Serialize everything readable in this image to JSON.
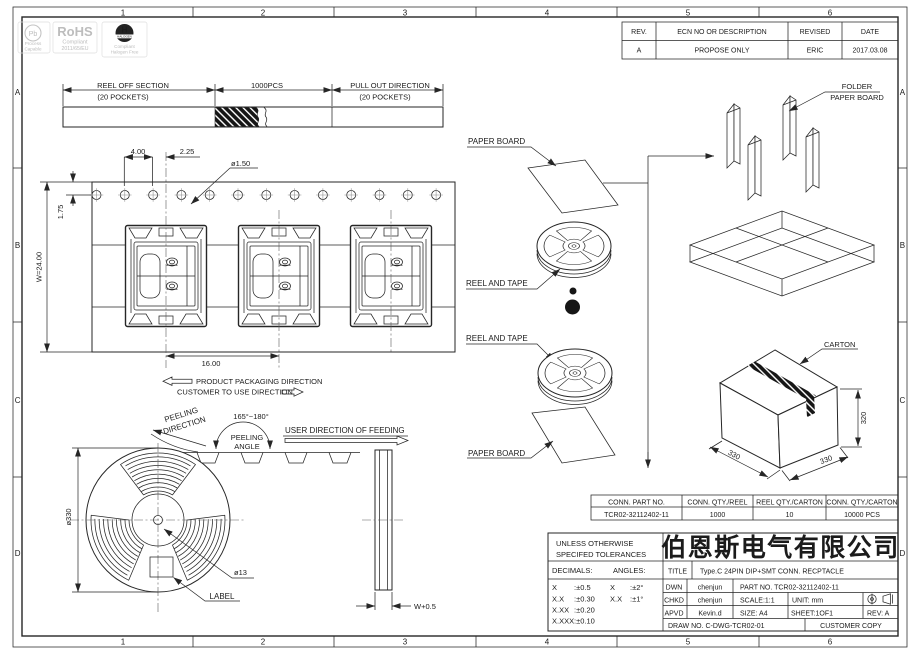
{
  "grid": {
    "cols": [
      "1",
      "2",
      "3",
      "4",
      "5",
      "6"
    ],
    "rows": [
      "A",
      "B",
      "C",
      "D"
    ]
  },
  "logos": {
    "pb": {
      "symbol": "Pb",
      "caption1": "Process",
      "caption2": "Capable"
    },
    "rohs": {
      "title": "RoHS",
      "caption1": "Compliant",
      "caption2": "2011/65/EU"
    },
    "halogen": {
      "symbol": "H",
      "band": "HALOGEN",
      "caption1": "Compliant",
      "caption2": "Halogen Free"
    }
  },
  "revision_table": {
    "headers": [
      "REV.",
      "ECN NO OR DESCRIPTION",
      "REVISED",
      "DATE"
    ],
    "rows": [
      [
        "A",
        "PROPOSE ONLY",
        "ERIC",
        "2017.03.08"
      ]
    ]
  },
  "reel_off": {
    "left_title": "REEL OFF SECTION",
    "left_sub": "(20 POCKETS)",
    "center": "1000PCS",
    "right_title": "PULL OUT DIRECTION",
    "right_sub": "(20 POCKETS)"
  },
  "tape": {
    "dim_pitch": "4.00",
    "dim_offset": "2.25",
    "dim_hole": "ø1.50",
    "dim_edge": "1.75",
    "dim_width": "W=24.00",
    "dim_pocket_pitch": "16.00"
  },
  "directions": {
    "packaging": "PRODUCT PACKAGING DIRECTION",
    "customer": "CUSTOMER TO USE DIRECTION"
  },
  "peeling": {
    "dir1": "PEELING",
    "dir2": "DIRECTION",
    "angle_range": "165°~180°",
    "angle1": "PEELING",
    "angle2": "ANGLE",
    "feeding": "USER DIRECTION OF FEEDING"
  },
  "reel_view": {
    "diameter": "ø330",
    "hub": "ø13",
    "label": "LABEL",
    "side_width": "W+0.5"
  },
  "packing": {
    "paper_board": "PAPER BOARD",
    "reel_and_tape": "REEL AND TAPE",
    "folder1": "FOLDER",
    "folder2": "PAPER BOARD",
    "carton": "CARTON",
    "dim_height": "320",
    "dim_left": "330",
    "dim_right": "330"
  },
  "qty_table": {
    "headers": [
      "CONN. PART NO.",
      "CONN. QTY./REEL",
      "REEL QTY./CARTON",
      "CONN. QTY./CARTON"
    ],
    "rows": [
      [
        "TCR02-32112402-11",
        "1000",
        "10",
        "10000 PCS"
      ]
    ]
  },
  "title_block": {
    "tol_header1": "UNLESS OTHERWISE",
    "tol_header2": "SPECIFED TOLERANCES",
    "decimals_label": "DECIMALS:",
    "angles_label": "ANGLES:",
    "decimals": [
      {
        "n": "X",
        "v": ":±0.5"
      },
      {
        "n": "X.X",
        "v": ":±0.30"
      },
      {
        "n": "X.XX",
        "v": ":±0.20"
      },
      {
        "n": "X.XXX",
        "v": ":±0.10"
      }
    ],
    "angles": [
      {
        "n": "X",
        "v": ":±2°"
      },
      {
        "n": "X.X",
        "v": ":±1°"
      }
    ],
    "company": "伯恩斯电气有限公司",
    "title_label": "TITLE",
    "title_value": "Type.C 24PIN DIP+SMT  CONN. RECPTACLE",
    "dwn_label": "DWN",
    "dwn_value": "chenjun",
    "part_no": "PART NO. TCR02-32112402-11",
    "chkd_label": "CHKD",
    "chkd_value": "chenjun",
    "scale": "SCALE:1:1",
    "unit": "UNIT:  mm",
    "apvd_label": "APVD",
    "apvd_value": "Kevin.d",
    "size": "SIZE: A4",
    "sheet": "SHEET:1OF1",
    "rev": "REV: A",
    "draw_no": "DRAW NO. C-DWG-TCR02-01",
    "copy": "CUSTOMER COPY"
  }
}
